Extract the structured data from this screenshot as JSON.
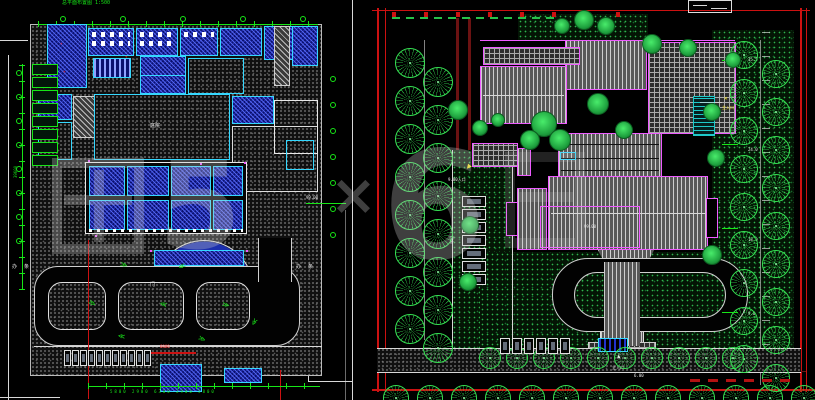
{
  "text": {
    "left": {
      "top_note": "总平面布置图 1:500",
      "court_label": "庭院",
      "level_note": "99.00",
      "ban": "办",
      "tiao": "条",
      "men": "门",
      "red_note": "6000",
      "dims_bottom": "5800  2900  6300  2900  5800",
      "dims_left": "39600"
    },
    "right": {
      "west_entrance": "9.00入口",
      "east_entrance": "主入口",
      "south_entrance": "主入口",
      "south_level": "6.00",
      "roof_note": "99.00",
      "parking_label": "车位",
      "east_dims": [
        "35.5",
        "24.0",
        "18.0",
        "9.0"
      ]
    },
    "watermark": {
      "glyph2": "5",
      "times": "×",
      "six": "6"
    }
  },
  "colors": {
    "background": "#000000",
    "frame_red": "#cc1111",
    "dark_red_road": "#6b1212",
    "magenta_outline": "#ee5bff",
    "cyan_wall": "#35d8ff",
    "blue_room": "#0b1070",
    "dimension_green": "#17e617",
    "tree_green": "#35e052",
    "lawn_dot_green": "#2db54d",
    "watermark_gray": "#d0d0d0",
    "entrance_yellow": "#f5e11e"
  },
  "decor": {
    "rows": [
      {
        "c": "tree-o",
        "container": "rp-deco",
        "x0": 395,
        "y": 48,
        "dy": 38,
        "n": 8,
        "w": 30,
        "h": 30
      },
      {
        "c": "tree-o",
        "container": "rp-deco",
        "x0": 423,
        "y": 67,
        "dy": 38,
        "n": 8,
        "w": 30,
        "h": 30
      },
      {
        "c": "tree-o",
        "container": "rp-deco",
        "x0": 730,
        "y": 41,
        "dy": 38,
        "n": 9,
        "w": 28,
        "h": 28
      },
      {
        "c": "tree-o",
        "container": "rp-deco",
        "x0": 762,
        "y": 60,
        "dy": 38,
        "n": 9,
        "w": 28,
        "h": 28
      },
      {
        "c": "tree-o",
        "container": "rp-deco",
        "x0": 479,
        "y": 347,
        "dx": 27,
        "n": 10,
        "w": 22,
        "h": 22
      },
      {
        "c": "tree-o",
        "container": "rp-deco",
        "x0": 383,
        "y": 385,
        "dx": 34,
        "n": 13,
        "w": 26,
        "h": 26
      },
      {
        "c": "stall",
        "container": "rp-deco",
        "x0": 462,
        "y": 196,
        "dy": 13,
        "n": 7,
        "w": 24,
        "h": 11
      },
      {
        "c": "stall",
        "container": "rp-deco",
        "x0": 500,
        "y": 338,
        "dx": 12,
        "n": 6,
        "w": 10,
        "h": 16
      },
      {
        "c": "stall",
        "container": "lp-deco",
        "x0": 64,
        "y": 350,
        "dx": 8,
        "n": 11,
        "w": 7,
        "h": 16
      },
      {
        "c": "bubble",
        "container": "lp-deco",
        "x0": 60,
        "y": 16,
        "dx": 60,
        "n": 5,
        "w": 6,
        "h": 6
      },
      {
        "c": "bubble",
        "container": "lp-deco",
        "x0": 16,
        "y": 70,
        "dy": 24,
        "n": 8,
        "w": 6,
        "h": 6
      },
      {
        "c": "bubble",
        "container": "lp-deco",
        "x0": 330,
        "y": 76,
        "dy": 26,
        "n": 7,
        "w": 6,
        "h": 6
      },
      {
        "c": "stackblk",
        "container": "lp-deco",
        "x0": 32,
        "y": 64,
        "dy": 13,
        "n": 8,
        "w": 26,
        "h": 11
      },
      {
        "c": "redtick",
        "container": "rp-deco",
        "x0": 392,
        "y": 12,
        "dx": 32,
        "n": 8,
        "w": 4,
        "h": 5
      },
      {
        "c": "hedge",
        "container": "rp-deco",
        "x0": 392,
        "y": 17,
        "dx": 14,
        "n": 12,
        "w": 8,
        "h": 2
      },
      {
        "c": "reddash",
        "container": "rp-deco",
        "x0": 690,
        "y": 379,
        "dx": 18,
        "n": 6,
        "w": 10,
        "h": 3
      },
      {
        "c": "etick",
        "container": "rp-deco",
        "x0": 722,
        "y": 60,
        "dy": 84,
        "n": 4,
        "w": 16,
        "h": 1
      }
    ],
    "filled_trees": [
      [
        544,
        124,
        13
      ],
      [
        560,
        140,
        11
      ],
      [
        530,
        140,
        10
      ],
      [
        598,
        104,
        11
      ],
      [
        624,
        130,
        9
      ],
      [
        652,
        44,
        10
      ],
      [
        688,
        48,
        9
      ],
      [
        712,
        112,
        9
      ],
      [
        716,
        158,
        9
      ],
      [
        712,
        255,
        10
      ],
      [
        480,
        128,
        8
      ],
      [
        458,
        110,
        10
      ],
      [
        470,
        225,
        9
      ],
      [
        468,
        282,
        9
      ],
      [
        584,
        20,
        10
      ],
      [
        606,
        26,
        9
      ],
      [
        562,
        26,
        8
      ],
      [
        498,
        120,
        7
      ],
      [
        733,
        60,
        8
      ]
    ],
    "arrows": [
      [
        120,
        262,
        20
      ],
      [
        178,
        262,
        160
      ],
      [
        88,
        300,
        30
      ],
      [
        160,
        300,
        200
      ],
      [
        222,
        302,
        15
      ],
      [
        118,
        332,
        190
      ],
      [
        198,
        336,
        25
      ],
      [
        250,
        318,
        120
      ]
    ],
    "red_crosses": [
      [
        60,
        42
      ],
      [
        63,
        70
      ],
      [
        125,
        55
      ]
    ],
    "magenta_dots": [
      [
        88,
        160
      ],
      [
        244,
        162
      ],
      [
        150,
        250
      ],
      [
        246,
        250
      ],
      [
        95,
        235
      ],
      [
        200,
        163
      ]
    ]
  }
}
